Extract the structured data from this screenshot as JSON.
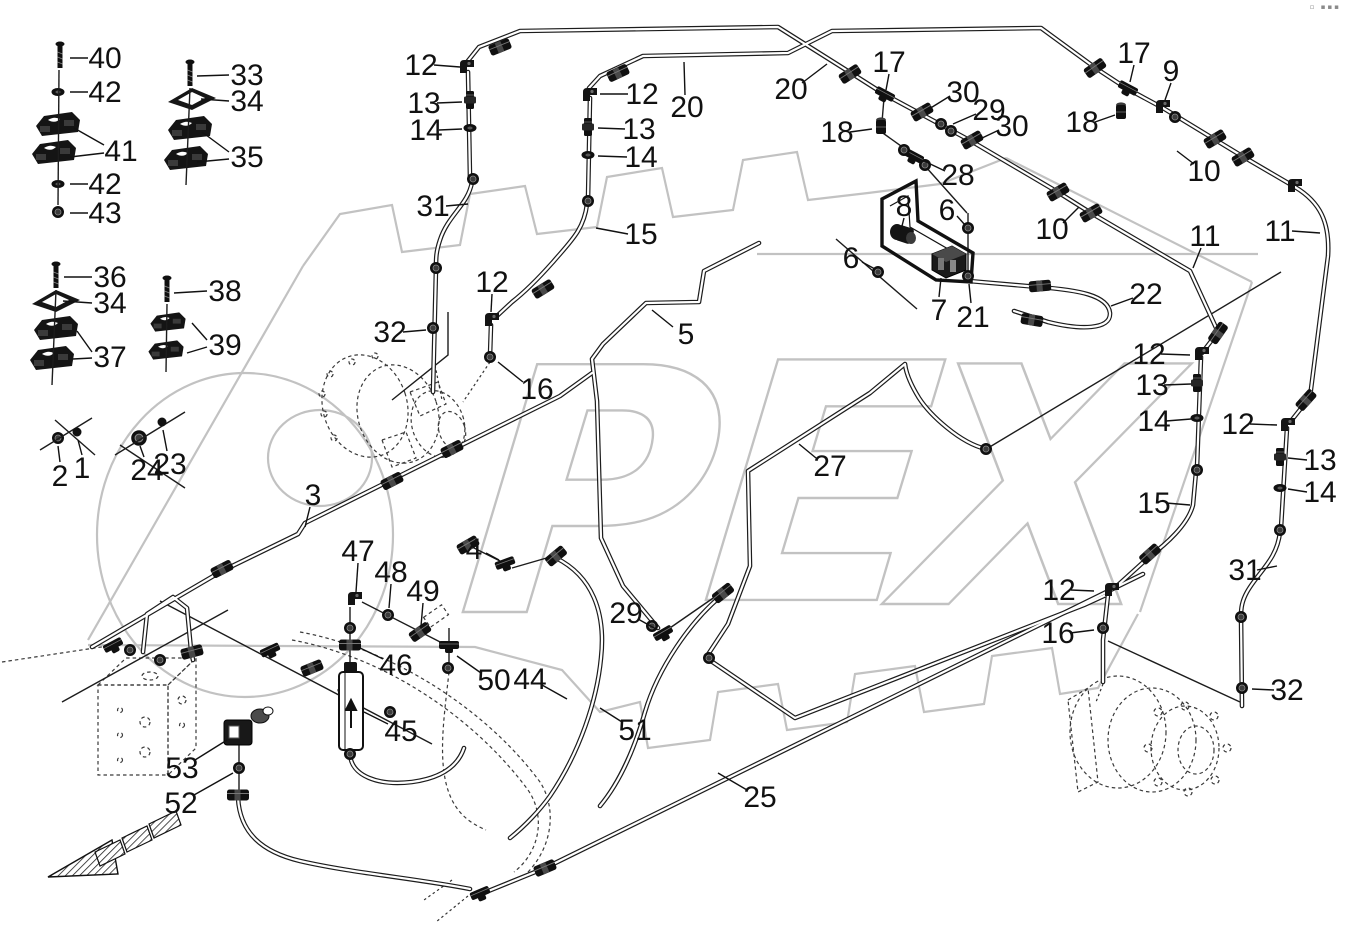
{
  "page": {
    "background": "#ffffff",
    "corner_mark": "▫ ▪▪▪"
  },
  "watermark": {
    "text": "OPEX",
    "color": "#c2c2c2"
  },
  "diagram": {
    "description": "Hydraulic pipes / brake lines exploded parts diagram",
    "line_color": "#1c1c1c"
  },
  "labels": [
    {
      "text": "40",
      "x": 105,
      "y": 58,
      "leads": [
        [
          88,
          58,
          70,
          58
        ]
      ]
    },
    {
      "text": "42",
      "x": 105,
      "y": 92,
      "leads": [
        [
          88,
          92,
          70,
          92
        ]
      ]
    },
    {
      "text": "41",
      "x": 121,
      "y": 151,
      "leads": [
        [
          104,
          145,
          74,
          128
        ],
        [
          104,
          153,
          70,
          157
        ]
      ]
    },
    {
      "text": "42",
      "x": 105,
      "y": 184,
      "leads": [
        [
          88,
          184,
          70,
          184
        ]
      ]
    },
    {
      "text": "43",
      "x": 105,
      "y": 213,
      "leads": [
        [
          88,
          213,
          70,
          213
        ]
      ]
    },
    {
      "text": "33",
      "x": 247,
      "y": 75,
      "leads": [
        [
          229,
          75,
          197,
          76
        ]
      ]
    },
    {
      "text": "34",
      "x": 247,
      "y": 101,
      "leads": [
        [
          229,
          101,
          201,
          99
        ]
      ]
    },
    {
      "text": "35",
      "x": 247,
      "y": 157,
      "leads": [
        [
          229,
          152,
          202,
          132
        ],
        [
          229,
          159,
          197,
          162
        ]
      ]
    },
    {
      "text": "36",
      "x": 110,
      "y": 277,
      "leads": [
        [
          92,
          277,
          64,
          277
        ]
      ]
    },
    {
      "text": "34",
      "x": 110,
      "y": 303,
      "leads": [
        [
          92,
          303,
          63,
          301
        ]
      ]
    },
    {
      "text": "37",
      "x": 110,
      "y": 357,
      "leads": [
        [
          92,
          352,
          77,
          331
        ],
        [
          92,
          358,
          73,
          359
        ]
      ]
    },
    {
      "text": "38",
      "x": 225,
      "y": 291,
      "leads": [
        [
          207,
          291,
          174,
          293
        ]
      ]
    },
    {
      "text": "39",
      "x": 225,
      "y": 345,
      "leads": [
        [
          207,
          340,
          192,
          323
        ],
        [
          207,
          347,
          187,
          353
        ]
      ]
    },
    {
      "text": "2",
      "x": 60,
      "y": 476,
      "leads": [
        [
          60,
          462,
          58,
          446
        ]
      ]
    },
    {
      "text": "1",
      "x": 82,
      "y": 468,
      "leads": [
        [
          82,
          455,
          78,
          440
        ]
      ]
    },
    {
      "text": "24",
      "x": 147,
      "y": 470,
      "leads": [
        [
          144,
          457,
          140,
          446
        ]
      ]
    },
    {
      "text": "23",
      "x": 170,
      "y": 464,
      "leads": [
        [
          167,
          451,
          163,
          430
        ]
      ]
    },
    {
      "text": "12",
      "x": 421,
      "y": 65,
      "leads": [
        [
          434,
          65,
          460,
          67
        ]
      ]
    },
    {
      "text": "13",
      "x": 424,
      "y": 103,
      "leads": [
        [
          437,
          103,
          462,
          102
        ]
      ]
    },
    {
      "text": "14",
      "x": 426,
      "y": 130,
      "leads": [
        [
          439,
          130,
          462,
          129
        ]
      ]
    },
    {
      "text": "31",
      "x": 433,
      "y": 206,
      "leads": [
        [
          446,
          206,
          468,
          204
        ]
      ]
    },
    {
      "text": "12",
      "x": 642,
      "y": 94,
      "leads": [
        [
          628,
          94,
          600,
          94
        ]
      ]
    },
    {
      "text": "20",
      "x": 687,
      "y": 107,
      "leads": [
        [
          685,
          95,
          684,
          62
        ]
      ]
    },
    {
      "text": "13",
      "x": 639,
      "y": 129,
      "leads": [
        [
          625,
          129,
          598,
          128
        ]
      ]
    },
    {
      "text": "14",
      "x": 641,
      "y": 157,
      "leads": [
        [
          627,
          157,
          598,
          156
        ]
      ]
    },
    {
      "text": "15",
      "x": 641,
      "y": 234,
      "leads": [
        [
          628,
          234,
          596,
          228
        ]
      ]
    },
    {
      "text": "20",
      "x": 791,
      "y": 89,
      "leads": [
        [
          802,
          83,
          827,
          64
        ]
      ]
    },
    {
      "text": "17",
      "x": 889,
      "y": 62,
      "leads": [
        [
          889,
          74,
          886,
          90
        ]
      ]
    },
    {
      "text": "30",
      "x": 963,
      "y": 92,
      "leads": [
        [
          950,
          96,
          929,
          109
        ]
      ]
    },
    {
      "text": "29",
      "x": 989,
      "y": 110,
      "leads": [
        [
          976,
          114,
          953,
          124
        ]
      ]
    },
    {
      "text": "30",
      "x": 1012,
      "y": 126,
      "leads": [
        [
          999,
          130,
          980,
          139
        ]
      ]
    },
    {
      "text": "18",
      "x": 837,
      "y": 132,
      "leads": [
        [
          850,
          132,
          872,
          129
        ]
      ]
    },
    {
      "text": "28",
      "x": 958,
      "y": 175,
      "leads": [
        [
          945,
          171,
          924,
          161
        ]
      ]
    },
    {
      "text": "8",
      "x": 904,
      "y": 206,
      "leads": [
        [
          904,
          218,
          901,
          230
        ]
      ]
    },
    {
      "text": "6",
      "x": 947,
      "y": 210,
      "leads": [
        [
          957,
          216,
          965,
          225
        ]
      ]
    },
    {
      "text": "10",
      "x": 1052,
      "y": 229,
      "leads": [
        [
          1063,
          223,
          1079,
          207
        ]
      ]
    },
    {
      "text": "6",
      "x": 851,
      "y": 258,
      "leads": [
        [
          862,
          262,
          875,
          269
        ]
      ]
    },
    {
      "text": "7",
      "x": 939,
      "y": 310,
      "leads": [
        [
          939,
          297,
          941,
          278
        ]
      ]
    },
    {
      "text": "21",
      "x": 973,
      "y": 317,
      "leads": [
        [
          971,
          303,
          969,
          284
        ]
      ]
    },
    {
      "text": "17",
      "x": 1134,
      "y": 53,
      "leads": [
        [
          1134,
          65,
          1130,
          82
        ]
      ]
    },
    {
      "text": "9",
      "x": 1171,
      "y": 71,
      "leads": [
        [
          1171,
          83,
          1165,
          100
        ]
      ]
    },
    {
      "text": "18",
      "x": 1082,
      "y": 122,
      "leads": [
        [
          1095,
          122,
          1115,
          115
        ]
      ]
    },
    {
      "text": "10",
      "x": 1204,
      "y": 171,
      "leads": [
        [
          1194,
          164,
          1177,
          151
        ]
      ]
    },
    {
      "text": "11",
      "x": 1280,
      "y": 231,
      "leads": [
        [
          1292,
          231,
          1320,
          233
        ]
      ]
    },
    {
      "text": "11",
      "x": 1205,
      "y": 236,
      "leads": [
        [
          1201,
          248,
          1193,
          268
        ]
      ]
    },
    {
      "text": "22",
      "x": 1146,
      "y": 294,
      "leads": [
        [
          1133,
          298,
          1111,
          306
        ]
      ]
    },
    {
      "text": "32",
      "x": 390,
      "y": 332,
      "leads": [
        [
          403,
          332,
          426,
          330
        ]
      ]
    },
    {
      "text": "12",
      "x": 492,
      "y": 282,
      "leads": [
        [
          492,
          294,
          491,
          312
        ]
      ]
    },
    {
      "text": "16",
      "x": 537,
      "y": 389,
      "leads": [
        [
          523,
          382,
          498,
          362
        ]
      ]
    },
    {
      "text": "5",
      "x": 686,
      "y": 334,
      "leads": [
        [
          673,
          327,
          652,
          310
        ]
      ]
    },
    {
      "text": "27",
      "x": 830,
      "y": 466,
      "leads": [
        [
          816,
          458,
          799,
          444
        ]
      ]
    },
    {
      "text": "3",
      "x": 313,
      "y": 495,
      "leads": [
        [
          310,
          507,
          305,
          527
        ]
      ]
    },
    {
      "text": "4",
      "x": 474,
      "y": 549,
      "leads": [
        [
          486,
          553,
          499,
          560
        ]
      ]
    },
    {
      "text": "47",
      "x": 358,
      "y": 551,
      "leads": [
        [
          358,
          563,
          356,
          592
        ]
      ]
    },
    {
      "text": "48",
      "x": 391,
      "y": 572,
      "leads": [
        [
          391,
          584,
          389,
          608
        ]
      ]
    },
    {
      "text": "49",
      "x": 423,
      "y": 591,
      "leads": [
        [
          423,
          603,
          421,
          626
        ]
      ]
    },
    {
      "text": "46",
      "x": 396,
      "y": 665,
      "leads": [
        [
          383,
          659,
          358,
          647
        ]
      ]
    },
    {
      "text": "50",
      "x": 494,
      "y": 680,
      "leads": [
        [
          481,
          673,
          457,
          656
        ]
      ]
    },
    {
      "text": "44",
      "x": 530,
      "y": 679,
      "leads": [
        [
          542,
          685,
          567,
          699
        ]
      ]
    },
    {
      "text": "45",
      "x": 401,
      "y": 731,
      "leads": [
        [
          388,
          724,
          364,
          712
        ]
      ]
    },
    {
      "text": "51",
      "x": 635,
      "y": 730,
      "leads": [
        [
          622,
          722,
          600,
          708
        ]
      ]
    },
    {
      "text": "29",
      "x": 626,
      "y": 613,
      "leads": [
        [
          638,
          619,
          656,
          629
        ]
      ]
    },
    {
      "text": "25",
      "x": 760,
      "y": 797,
      "leads": [
        [
          747,
          790,
          718,
          773
        ]
      ]
    },
    {
      "text": "53",
      "x": 182,
      "y": 768,
      "leads": [
        [
          195,
          760,
          227,
          740
        ]
      ]
    },
    {
      "text": "52",
      "x": 181,
      "y": 803,
      "leads": [
        [
          194,
          795,
          233,
          773
        ]
      ]
    },
    {
      "text": "12",
      "x": 1149,
      "y": 354,
      "leads": [
        [
          1161,
          354,
          1190,
          355
        ]
      ]
    },
    {
      "text": "13",
      "x": 1152,
      "y": 385,
      "leads": [
        [
          1164,
          385,
          1191,
          384
        ]
      ]
    },
    {
      "text": "14",
      "x": 1154,
      "y": 421,
      "leads": [
        [
          1166,
          421,
          1191,
          419
        ]
      ]
    },
    {
      "text": "15",
      "x": 1154,
      "y": 503,
      "leads": [
        [
          1166,
          503,
          1190,
          505
        ]
      ]
    },
    {
      "text": "12",
      "x": 1238,
      "y": 424,
      "leads": [
        [
          1250,
          424,
          1277,
          425
        ]
      ]
    },
    {
      "text": "13",
      "x": 1320,
      "y": 460,
      "leads": [
        [
          1307,
          460,
          1288,
          458
        ]
      ]
    },
    {
      "text": "14",
      "x": 1320,
      "y": 492,
      "leads": [
        [
          1307,
          492,
          1288,
          489
        ]
      ]
    },
    {
      "text": "31",
      "x": 1245,
      "y": 570,
      "leads": [
        [
          1257,
          570,
          1277,
          566
        ]
      ]
    },
    {
      "text": "12",
      "x": 1059,
      "y": 590,
      "leads": [
        [
          1071,
          590,
          1094,
          591
        ]
      ]
    },
    {
      "text": "16",
      "x": 1058,
      "y": 633,
      "leads": [
        [
          1070,
          633,
          1094,
          630
        ]
      ]
    },
    {
      "text": "32",
      "x": 1287,
      "y": 690,
      "leads": [
        [
          1274,
          690,
          1252,
          689
        ]
      ]
    }
  ]
}
